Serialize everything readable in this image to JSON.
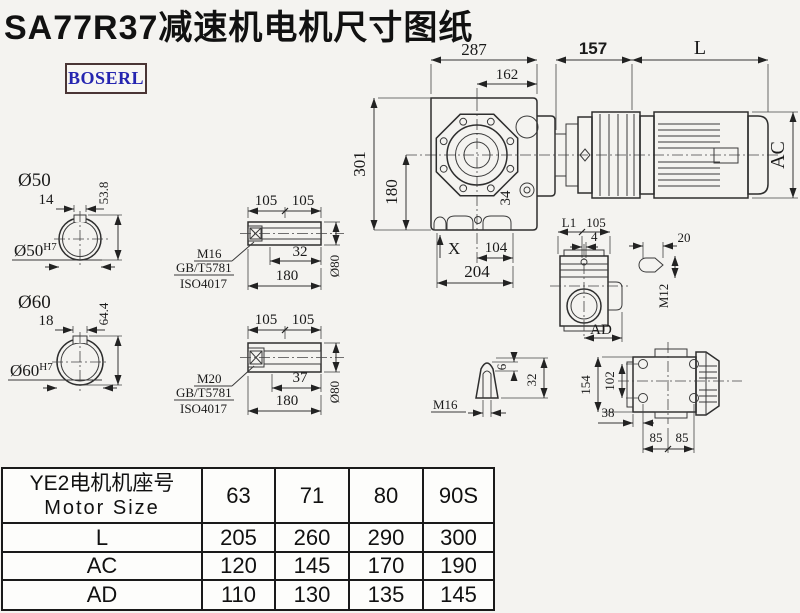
{
  "title": "SA77R37减速机电机尺寸图纸",
  "logo": "BOSERL",
  "colors": {
    "background": "#f4f3f0",
    "line": "#2e2e2e",
    "logo_text": "#2525b0",
    "logo_border": "#4a3535",
    "table_border": "#1a1a1a"
  },
  "main_view": {
    "dim_287": "287",
    "dim_162": "162",
    "dim_157": "157",
    "dim_L": "L",
    "dim_AC": "AC",
    "dim_301": "301",
    "dim_180": "180",
    "dim_34": "34",
    "dim_X": "X",
    "dim_104": "104",
    "dim_204": "204"
  },
  "shaft50": {
    "label": "Ø50",
    "dim_width": "14",
    "dim_depth": "53.8",
    "bore_label": "Ø50",
    "bore_tol": "H7"
  },
  "shaft60": {
    "label": "Ø60",
    "dim_width": "18",
    "dim_depth": "64.4",
    "bore_label": "Ø60",
    "bore_tol": "H7"
  },
  "sleeve1": {
    "dim_105a": "105",
    "dim_105b": "105",
    "thread": "M16",
    "std1": "GB/T5781",
    "std2": "ISO4017",
    "dim_32": "32",
    "dim_180": "180",
    "dim_d80": "Ø80"
  },
  "sleeve2": {
    "dim_105a": "105",
    "dim_105b": "105",
    "thread": "M20",
    "std1": "GB/T5781",
    "std2": "ISO4017",
    "dim_37": "37",
    "dim_180": "180",
    "dim_d80": "Ø80"
  },
  "side_view": {
    "dim_L1": "L1",
    "dim_105": "105",
    "dim_4": "4",
    "dim_AD": "AD"
  },
  "key_detail": {
    "dim_20": "20",
    "dim_M12": "M12"
  },
  "cone_detail": {
    "thread": "M16",
    "dim_6": "6",
    "dim_32": "32"
  },
  "rear_view": {
    "dim_154": "154",
    "dim_102": "102",
    "dim_38": "38",
    "dim_85a": "85",
    "dim_85b": "85"
  },
  "table": {
    "header_zh": "YE2电机机座号",
    "header_en": "Motor Size",
    "sizes": [
      "63",
      "71",
      "80",
      "90S"
    ],
    "rows": [
      {
        "label": "L",
        "values": [
          "205",
          "260",
          "290",
          "300"
        ]
      },
      {
        "label": "AC",
        "values": [
          "120",
          "145",
          "170",
          "190"
        ]
      },
      {
        "label": "AD",
        "values": [
          "110",
          "130",
          "135",
          "145"
        ]
      }
    ]
  }
}
